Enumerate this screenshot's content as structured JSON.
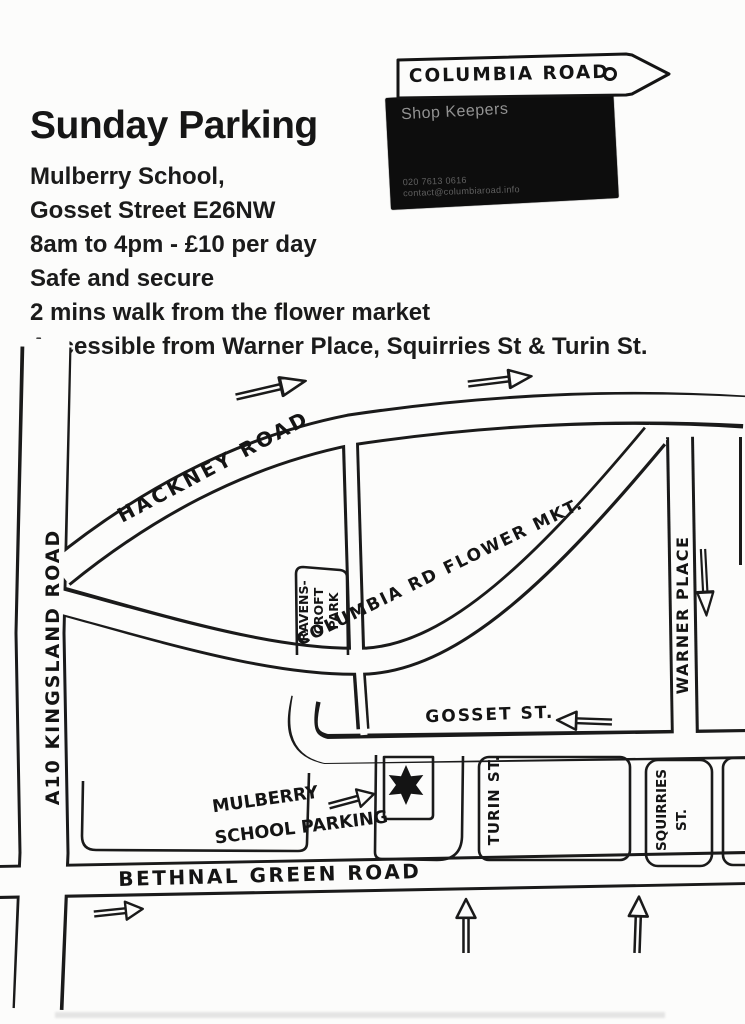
{
  "header": {
    "sign": {
      "label": "COLUMBIA ROAD"
    },
    "card": {
      "company": "Shop Keepers",
      "phone": "020 7613 0616",
      "email": "contact@columbiaroad.info"
    },
    "title": "Sunday Parking",
    "lines": [
      "Mulberry School,",
      "Gosset Street E26NW",
      "8am to 4pm - £10 per day",
      "Safe and secure",
      "2 mins walk from the flower market",
      "Accessible from Warner Place, Squirries St & Turin St."
    ]
  },
  "map": {
    "roads": {
      "a10": "A10 KINGSLAND ROAD",
      "hackney": "HACKNEY ROAD",
      "columbia": "COLUMBIA RD FLOWER MKT.",
      "gosset": "GOSSET ST.",
      "warner": "WARNER PLACE",
      "turin": "TURIN ST.",
      "squirries_line1": "SQUIRRIES",
      "squirries_line2": "ST.",
      "bethnal": "BETHNAL GREEN ROAD"
    },
    "park": {
      "line1": "RAVENS-",
      "line2": "CROFT",
      "line3": "PARK"
    },
    "school_label": {
      "line1": "MULBERRY",
      "line2": "SCHOOL PARKING"
    },
    "icons": {
      "marker": "six-pointed-star",
      "sign_pointer": "arrow-sign-right",
      "nail_hole": "circle-hole",
      "direction_arrows": [
        "right",
        "right",
        "left",
        "down",
        "right-to-parking",
        "right",
        "up",
        "up"
      ]
    }
  },
  "colors": {
    "ink": "#1a1a1a",
    "paper": "#fcfcfb",
    "card_bg": "#0d0d0d",
    "card_text": "#929292",
    "card_fine_text": "#606060"
  }
}
